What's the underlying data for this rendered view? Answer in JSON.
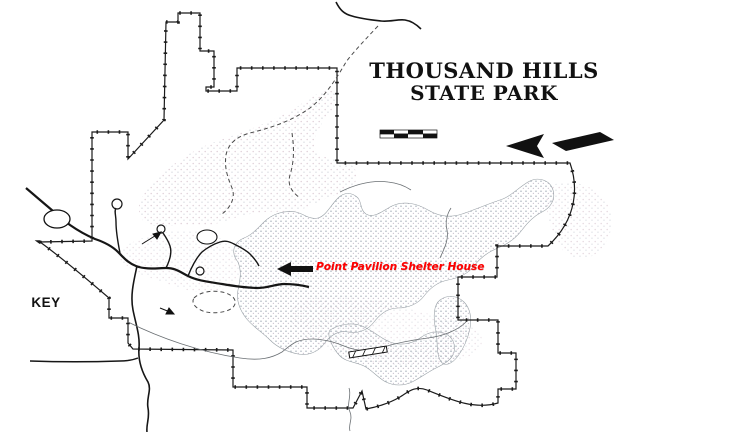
{
  "title": {
    "line1": "THOUSAND HILLS",
    "line2": "STATE PARK"
  },
  "annotation": {
    "text": "Point Pavilion Shelter House",
    "color": "#ff0000"
  },
  "key": {
    "heading": "KEY",
    "entries": [
      {
        "label": "Camping",
        "symbol": "C"
      },
      {
        "label": "Picnic Area",
        "symbol": "P"
      },
      {
        "label": "Shelter",
        "symbol": "S"
      },
      {
        "label": "Restroom",
        "symbol": "R"
      },
      {
        "label": "Park Office",
        "symbol": "PO"
      },
      {
        "label": "Bath House",
        "symbol": "BH"
      },
      {
        "label": "Cabins",
        "symbol": "Cb"
      },
      {
        "label": "Hiking and\nMountain Bicycling\nTrail",
        "symbol": "H",
        "dash": true
      }
    ]
  },
  "map": {
    "labels": [
      {
        "name": "co-rd-226-label",
        "text": "Co. Rd 226",
        "x": 297,
        "y": 8,
        "fs": 11
      },
      {
        "name": "trail-head-label",
        "text": "Trail Head",
        "x": 406,
        "y": 29,
        "fs": 11
      },
      {
        "name": "to-route-6-label",
        "text": "To Route 6",
        "x": 16,
        "y": 181,
        "fs": 10.5
      },
      {
        "name": "five-miles-label",
        "text": "5 miles",
        "x": 27,
        "y": 192,
        "fs": 10.5
      },
      {
        "name": "route-157-label",
        "text": "157",
        "x": 49,
        "y": 215,
        "fs": 9,
        "bold": true
      },
      {
        "name": "amphitheater-label",
        "text": "Amphitheater",
        "x": 24,
        "y": 242,
        "fs": 11
      },
      {
        "name": "petroglyph-label-line1",
        "text": "Petroglyph",
        "x": 110,
        "y": 247,
        "fs": 11
      },
      {
        "name": "petroglyph-label-line2",
        "text": "Shelter",
        "x": 124,
        "y": 258,
        "fs": 11
      },
      {
        "name": "dining-lodge-label",
        "text": "Dining Lodge",
        "x": 234,
        "y": 236,
        "fs": 11
      },
      {
        "name": "boathouse-label",
        "text": "Boathouse",
        "x": 236,
        "y": 248,
        "fs": 11
      },
      {
        "name": "thousand-hills-trail-label",
        "text": "Thousand Hills Trail",
        "x": 227,
        "y": 116,
        "fs": 10.5,
        "rot": -11
      },
      {
        "name": "forest-lake-label-line1",
        "text": "Forest",
        "x": 327,
        "y": 199,
        "fs": 11
      },
      {
        "name": "forest-lake-label-line2",
        "text": "Lake",
        "x": 331,
        "y": 211,
        "fs": 11
      },
      {
        "name": "hickory-trail-label-line1",
        "text": "Hickory",
        "x": 141,
        "y": 304,
        "fs": 11
      },
      {
        "name": "hickory-trail-label-line2",
        "text": "Trail",
        "x": 150,
        "y": 315,
        "fs": 11
      },
      {
        "name": "red-bud-trail-label",
        "text": "Red Bud Trail",
        "x": 231,
        "y": 316,
        "fs": 11
      },
      {
        "name": "dam-label",
        "text": "Dam",
        "x": 349,
        "y": 336,
        "fs": 11
      },
      {
        "name": "scale-top-left-label",
        "text": "660",
        "x": 371,
        "y": 121,
        "fs": 6.5
      },
      {
        "name": "scale-top-zero-label",
        "text": "0",
        "x": 397,
        "y": 121,
        "fs": 6.5
      },
      {
        "name": "scale-top-right-label",
        "text": "1320",
        "x": 420,
        "y": 121,
        "fs": 6.5
      },
      {
        "name": "scale-bottom-left-label",
        "text": "330",
        "x": 382,
        "y": 139,
        "fs": 6.5
      },
      {
        "name": "scale-bottom-right-label",
        "text": "660",
        "x": 405,
        "y": 139,
        "fs": 6.5
      },
      {
        "name": "scale-caption-label",
        "text": "SCALE IN FEET",
        "x": 377,
        "y": 147,
        "fs": 6.5
      },
      {
        "name": "north-label",
        "text": "N",
        "x": 481,
        "y": 132,
        "fs": 16,
        "bold": true
      }
    ],
    "markers": [
      {
        "t": "sq",
        "x": 371,
        "y": 17
      },
      {
        "t": "sq",
        "x": 91,
        "y": 231
      },
      {
        "t": "l",
        "x": 82,
        "y": 230,
        "text": "R"
      },
      {
        "t": "dot",
        "x": 96,
        "y": 247
      },
      {
        "t": "l",
        "x": 98,
        "y": 206,
        "text": "C"
      },
      {
        "t": "l",
        "x": 119,
        "y": 236,
        "text": "C"
      },
      {
        "t": "sq",
        "x": 161,
        "y": 225
      },
      {
        "t": "sq",
        "x": 169,
        "y": 225
      },
      {
        "t": "l",
        "x": 177,
        "y": 222,
        "text": "S"
      },
      {
        "t": "sq",
        "x": 194,
        "y": 222
      },
      {
        "t": "l",
        "x": 201,
        "y": 220,
        "text": "BH"
      },
      {
        "t": "l",
        "x": 166,
        "y": 232,
        "text": "C"
      },
      {
        "t": "l",
        "x": 179,
        "y": 232,
        "text": "R"
      },
      {
        "t": "l",
        "x": 200,
        "y": 232,
        "text": "Cb",
        "fs": 9.5
      },
      {
        "t": "sq",
        "x": 172,
        "y": 243
      },
      {
        "t": "sq",
        "x": 216,
        "y": 238
      },
      {
        "t": "sq",
        "x": 200,
        "y": 249
      },
      {
        "t": "sq",
        "x": 209,
        "y": 249
      },
      {
        "t": "sq",
        "x": 162,
        "y": 254
      },
      {
        "t": "l",
        "x": 180,
        "y": 259,
        "text": "R"
      },
      {
        "t": "l",
        "x": 193,
        "y": 262,
        "text": "C"
      },
      {
        "t": "sq",
        "x": 156,
        "y": 279
      },
      {
        "t": "l",
        "x": 167,
        "y": 276,
        "text": "S"
      },
      {
        "t": "l",
        "x": 248,
        "y": 271,
        "text": "R"
      },
      {
        "t": "sq",
        "x": 258,
        "y": 272
      },
      {
        "t": "l",
        "x": 261,
        "y": 262,
        "text": "S"
      },
      {
        "t": "sq",
        "x": 269,
        "y": 264
      },
      {
        "t": "sq",
        "x": 277,
        "y": 279
      },
      {
        "t": "l",
        "x": 285,
        "y": 277,
        "text": "S"
      },
      {
        "t": "sq",
        "x": 279,
        "y": 306
      },
      {
        "t": "l",
        "x": 287,
        "y": 304,
        "text": "S"
      },
      {
        "t": "l",
        "x": 179,
        "y": 288,
        "text": "P"
      },
      {
        "t": "l",
        "x": 204,
        "y": 283,
        "text": "P"
      },
      {
        "t": "sq",
        "x": 243,
        "y": 289
      },
      {
        "t": "l",
        "x": 252,
        "y": 287,
        "text": "P"
      },
      {
        "t": "l",
        "x": 371,
        "y": 176,
        "text": "H"
      },
      {
        "t": "l",
        "x": 443,
        "y": 240,
        "text": "H"
      },
      {
        "t": "l",
        "x": 283,
        "y": 338,
        "text": "H"
      },
      {
        "t": "l",
        "x": 262,
        "y": 352,
        "text": "H"
      },
      {
        "t": "l",
        "x": 424,
        "y": 333,
        "text": "H"
      }
    ]
  }
}
